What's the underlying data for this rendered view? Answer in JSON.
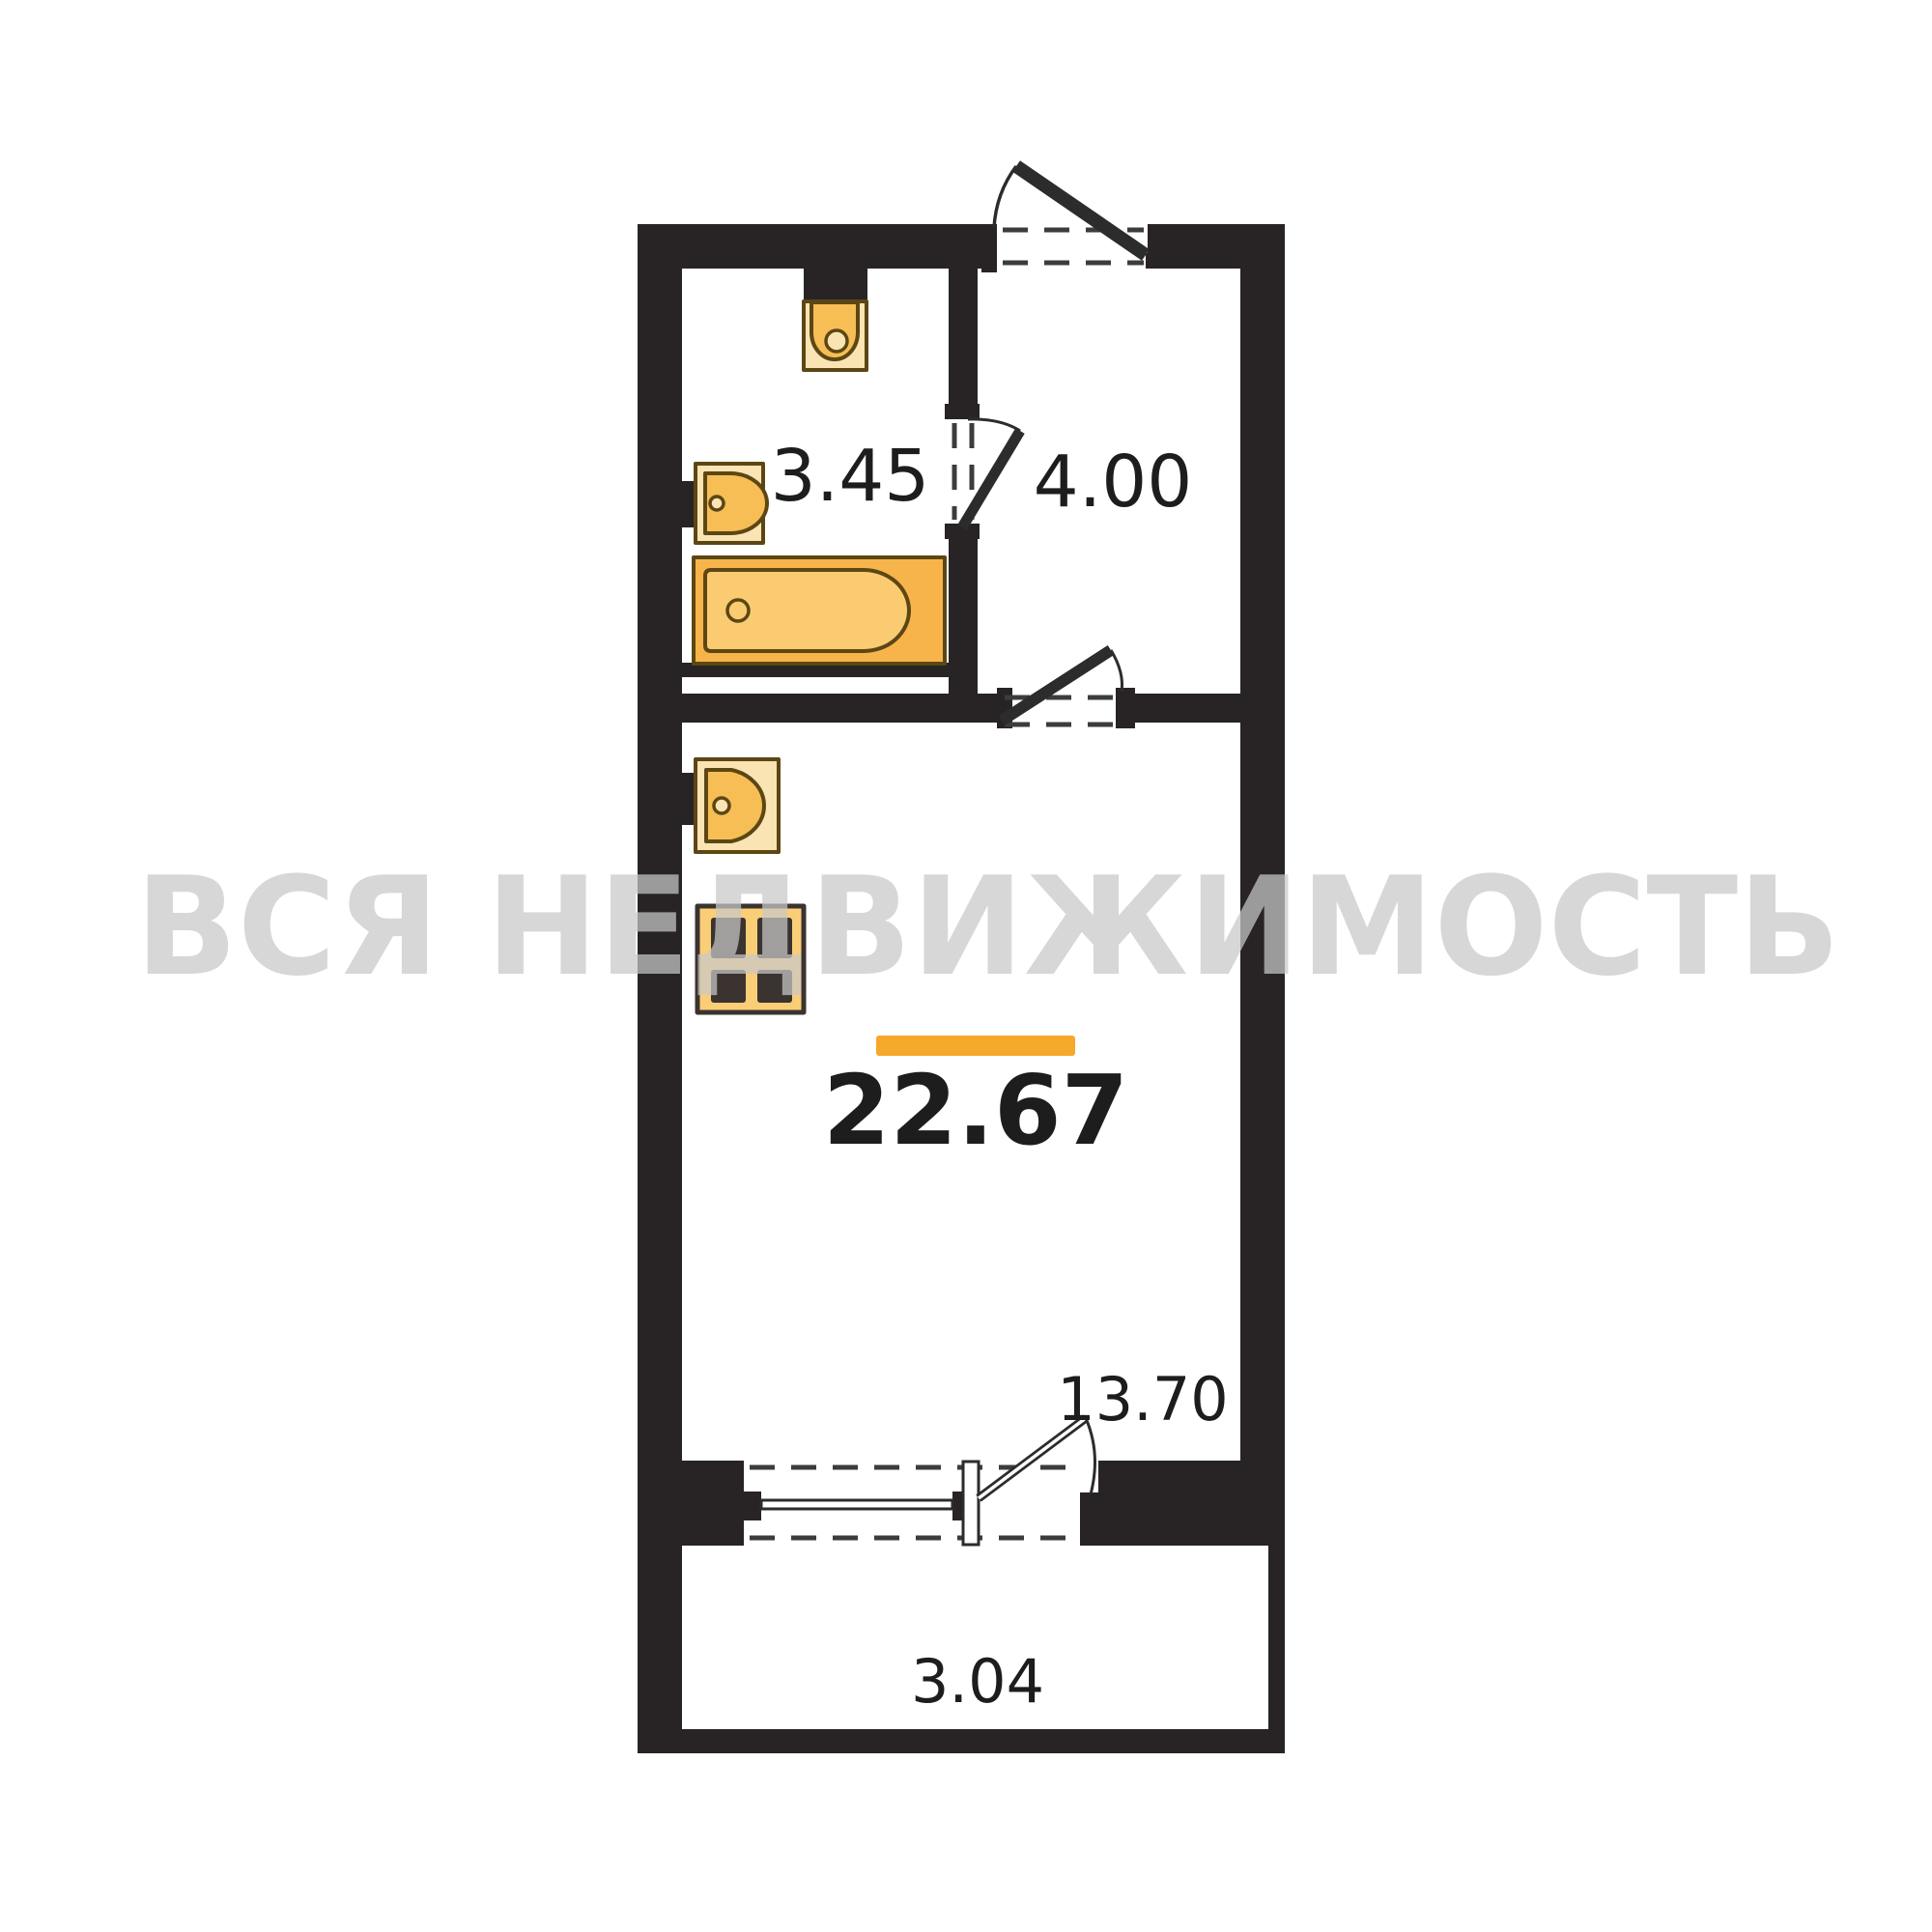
{
  "watermark": {
    "text": "ВСЯ НЕДВИЖИМОСТЬ"
  },
  "plan": {
    "total_area": "22.67",
    "rooms": {
      "bathroom": {
        "area": "3.45"
      },
      "hallway": {
        "area": "4.00"
      },
      "living_room": {
        "area": "13.70"
      },
      "balcony": {
        "area": "3.04"
      }
    },
    "colors": {
      "wall": "#282425",
      "line": "#2c2c2c",
      "dash": "#3c3c3c",
      "fixture_stroke": "#5c4714",
      "fixture_pale": "#fae4b3",
      "fixture_orange": "#f6be55",
      "tub_outer": "#f6b44b",
      "tub_inner": "#facb70",
      "stove_body": "#f9ce77",
      "burner": "#3a3330",
      "accent_bar": "#f6a82b",
      "label": "#1d1d1d",
      "watermark": "#c9c9c9"
    }
  }
}
